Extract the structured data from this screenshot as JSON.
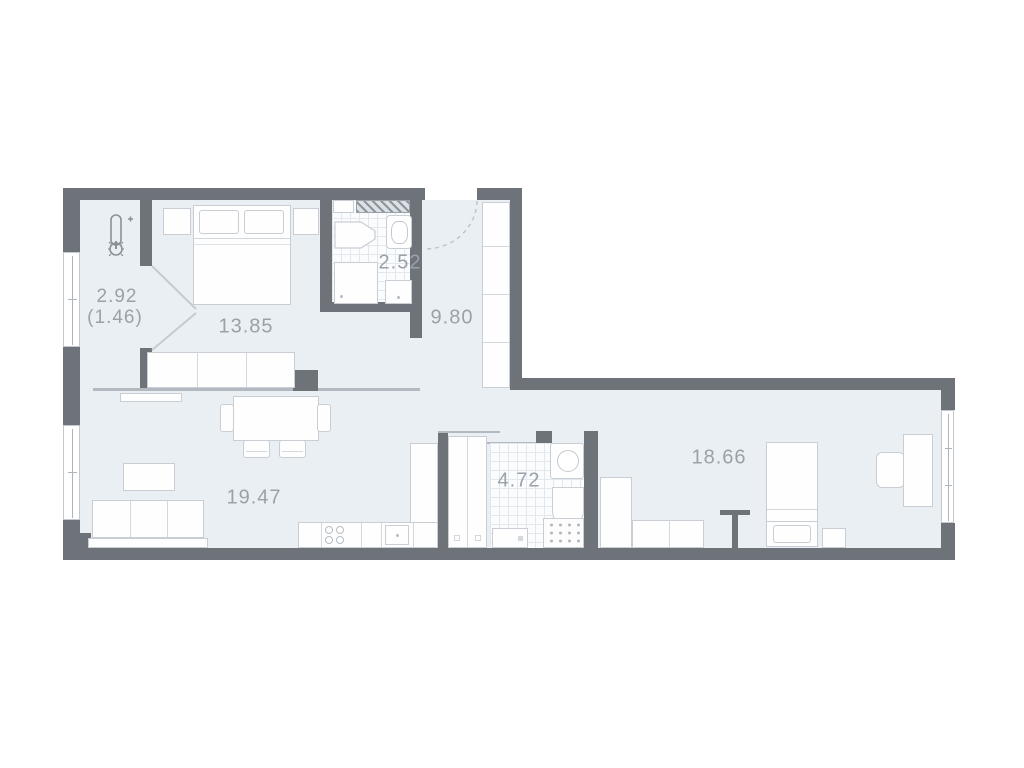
{
  "plan": {
    "type": "apartment-floor-plan",
    "rooms": [
      {
        "name": "loggia",
        "area": "2.92",
        "area_reduced": "(1.46)"
      },
      {
        "name": "bedroom",
        "area": "13.85"
      },
      {
        "name": "bathroom-small",
        "area": "2.52"
      },
      {
        "name": "hallway",
        "area": "9.80"
      },
      {
        "name": "living-kitchen",
        "area": "19.47"
      },
      {
        "name": "bathroom-large",
        "area": "4.72"
      },
      {
        "name": "bedroom-second",
        "area": "18.66"
      }
    ],
    "icons": [
      "thermometer-icon"
    ],
    "colors": {
      "wall": "#6e737a",
      "floor": "#eaeff4",
      "label": "#9aa1a9",
      "furniture_outline": "#c9ced4",
      "background": "#ffffff"
    }
  }
}
